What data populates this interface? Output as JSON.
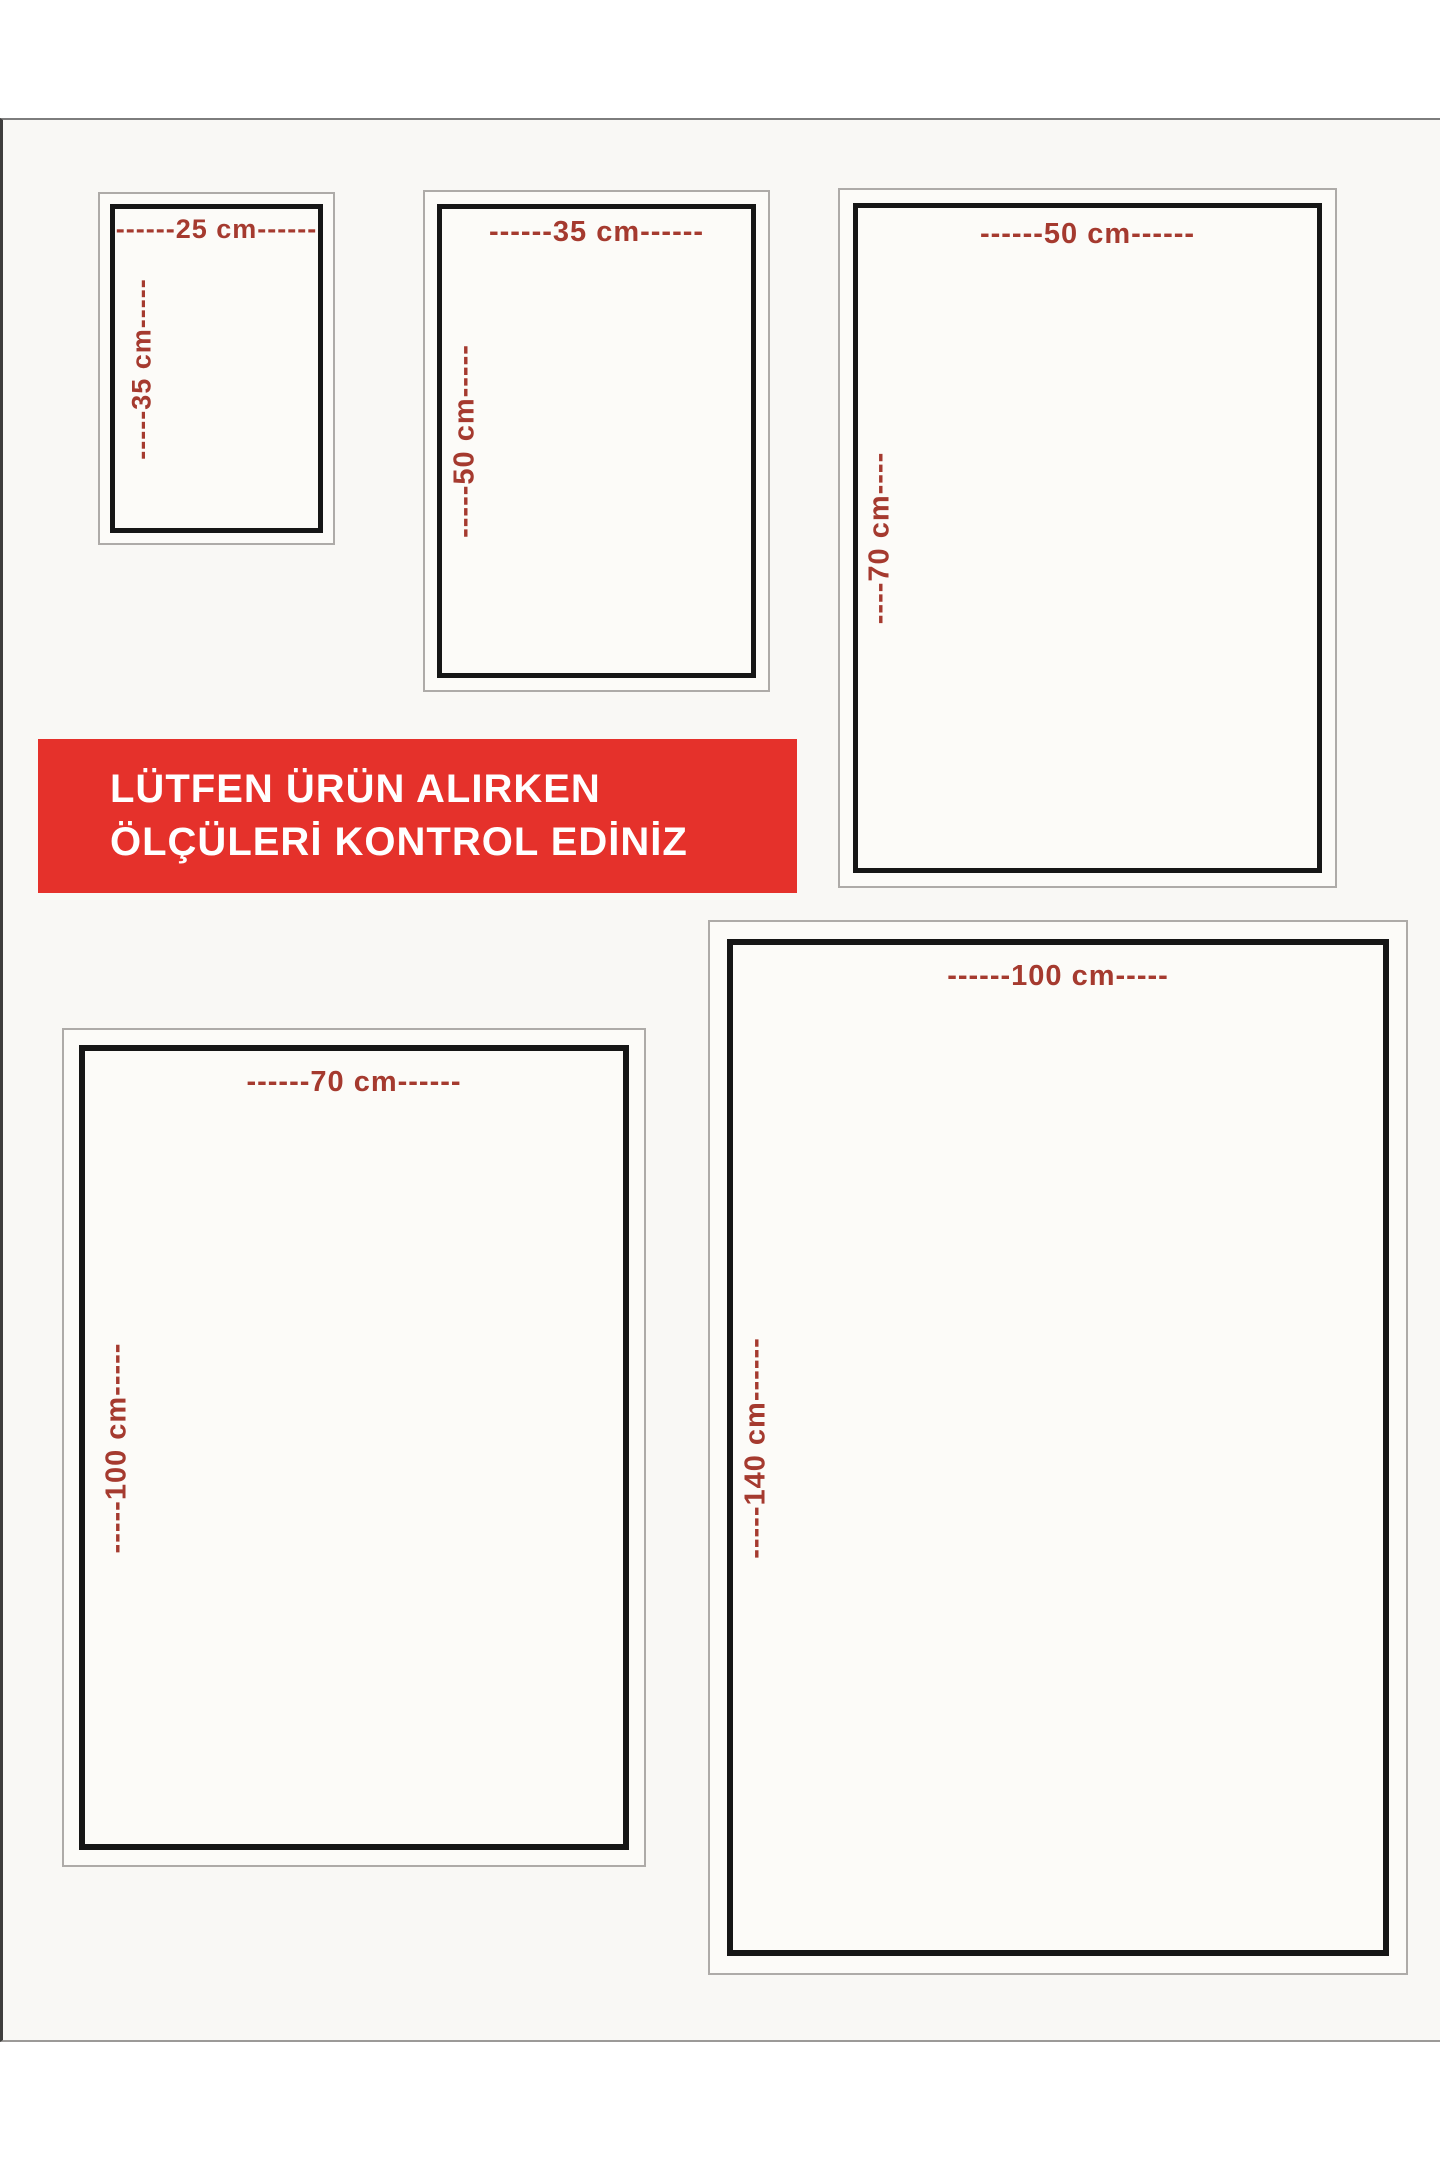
{
  "banner": {
    "line1": "LÜTFEN ÜRÜN ALIRKEN",
    "line2": "ÖLÇÜLERİ KONTROL EDİNİZ",
    "background_color": "#e5312b",
    "text_color": "#ffffff"
  },
  "boxes": [
    {
      "name": "25x35",
      "width_cm": 25,
      "height_cm": 35,
      "top_label": "------25 cm------",
      "side_label": "-----35 cm-----"
    },
    {
      "name": "35x50",
      "width_cm": 35,
      "height_cm": 50,
      "top_label": "------35 cm------",
      "side_label": "-----50 cm-----"
    },
    {
      "name": "50x70",
      "width_cm": 50,
      "height_cm": 70,
      "top_label": "------50 cm------",
      "side_label": "----70 cm----"
    },
    {
      "name": "70x100",
      "width_cm": 70,
      "height_cm": 100,
      "top_label": "------70 cm------",
      "side_label": "-----100 cm-----"
    },
    {
      "name": "100x140",
      "width_cm": 100,
      "height_cm": 140,
      "top_label": "------100 cm-----",
      "side_label": "-----140 cm------"
    }
  ],
  "colors": {
    "dimension_text": "#a53a2f",
    "inner_frame": "#161616",
    "outer_frame": "#aeaba8",
    "sheet_background": "#f9f8f5"
  }
}
